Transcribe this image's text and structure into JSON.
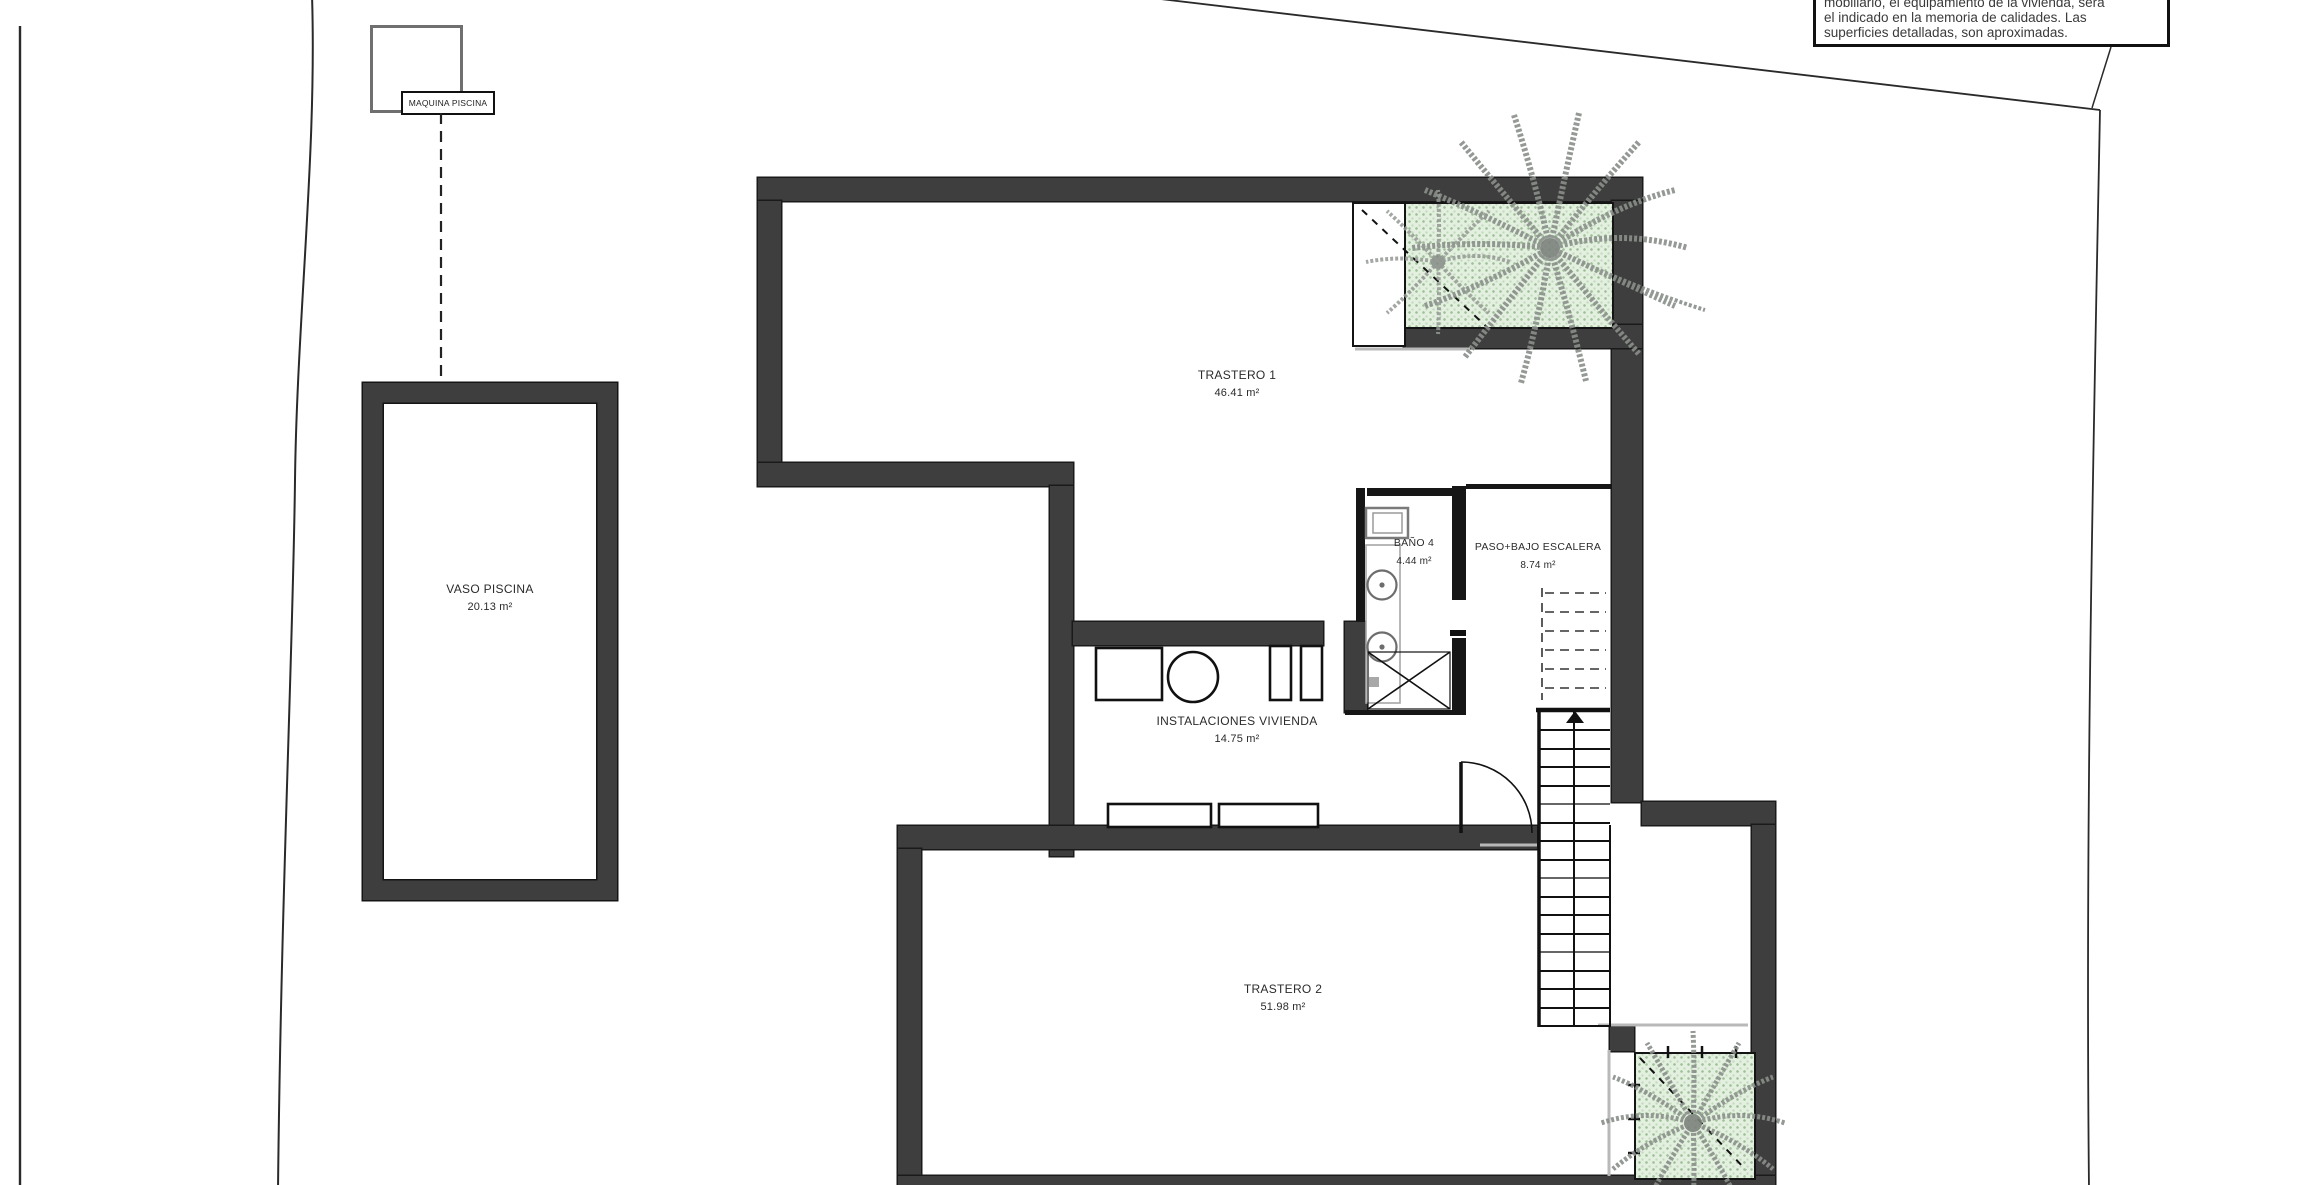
{
  "note": {
    "line0": "mobiliario, el equipamiento de la vivienda, será",
    "line1": "el indicado en la memoria de calidades. Las",
    "line2": "superficies detalladas, son aproximadas."
  },
  "equipment_label": "MAQUINA PISCINA",
  "rooms": [
    {
      "name": "TRASTERO 1",
      "area": "46.41 m²"
    },
    {
      "name": "BAÑO 4",
      "area": "4.44 m²"
    },
    {
      "name": "PASO+BAJO ESCALERA",
      "area": "8.74 m²"
    },
    {
      "name": "INSTALACIONES VIVIENDA",
      "area": "14.75 m²"
    },
    {
      "name": "TRASTERO 2",
      "area": "51.98 m²"
    },
    {
      "name": "VASO PISCINA",
      "area": "20.13 m²"
    }
  ],
  "colors": {
    "wall": "#3e3e3e",
    "thin_wall": "#161616",
    "planter_green": "#e3f0df",
    "palm": "#8a8f8a",
    "boundary_line": "#2a2a2a"
  }
}
